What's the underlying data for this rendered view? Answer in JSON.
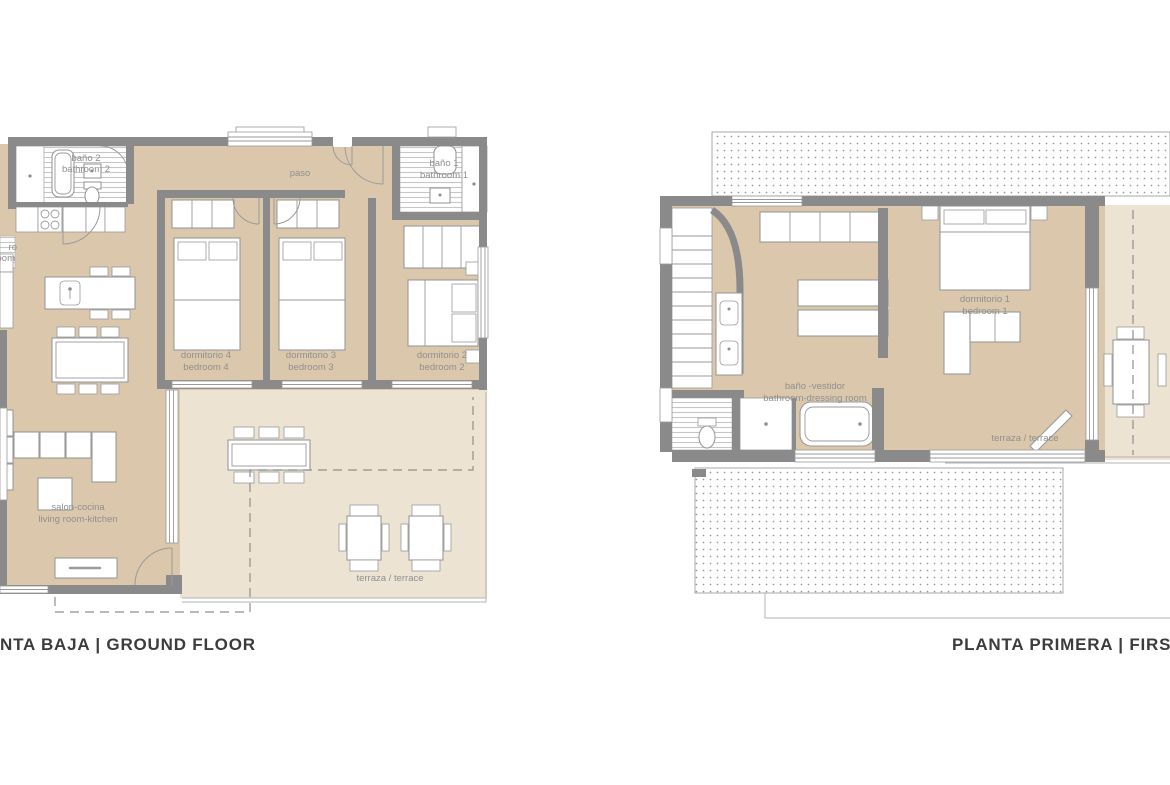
{
  "palette": {
    "background": "#ffffff",
    "floor": "#dbc8ac",
    "terrace": "#ece3d2",
    "wall": "#8a8a8a",
    "furniture_stroke": "#9a9a9a",
    "hatch_line": "#c6c6c6",
    "dot": "#9b9b9b",
    "label": "#8f8f8f",
    "title": "#3c3c3c"
  },
  "ground_floor": {
    "title": "NTA BAJA | GROUND FLOOR",
    "rooms": {
      "bano2": {
        "es": "baño 2",
        "en": "bathroom 2"
      },
      "paso": {
        "es": "paso"
      },
      "bano1": {
        "es": "baño 1",
        "en": "bathroom 1"
      },
      "cut_room": {
        "es": "ro",
        "en": "oom"
      },
      "dormitorio4": {
        "es": "dormitorio 4",
        "en": "bedroom 4"
      },
      "dormitorio3": {
        "es": "dormitorio 3",
        "en": "bedroom 3"
      },
      "dormitorio2": {
        "es": "dormitorio 2",
        "en": "bedroom 2"
      },
      "salon": {
        "es": "salon-cocina",
        "en": "living room-kitchen"
      },
      "terraza": {
        "es": "terraza / terrace"
      }
    }
  },
  "first_floor": {
    "title": "PLANTA PRIMERA | FIRST FLOO",
    "rooms": {
      "dormitorio1": {
        "es": "dormitorio 1",
        "en": "bedroom 1"
      },
      "bano_vestidor": {
        "es": "baño -vestidor",
        "en": "bathroom-dressing room"
      },
      "terraza": {
        "es": "terraza / terrace"
      }
    }
  }
}
